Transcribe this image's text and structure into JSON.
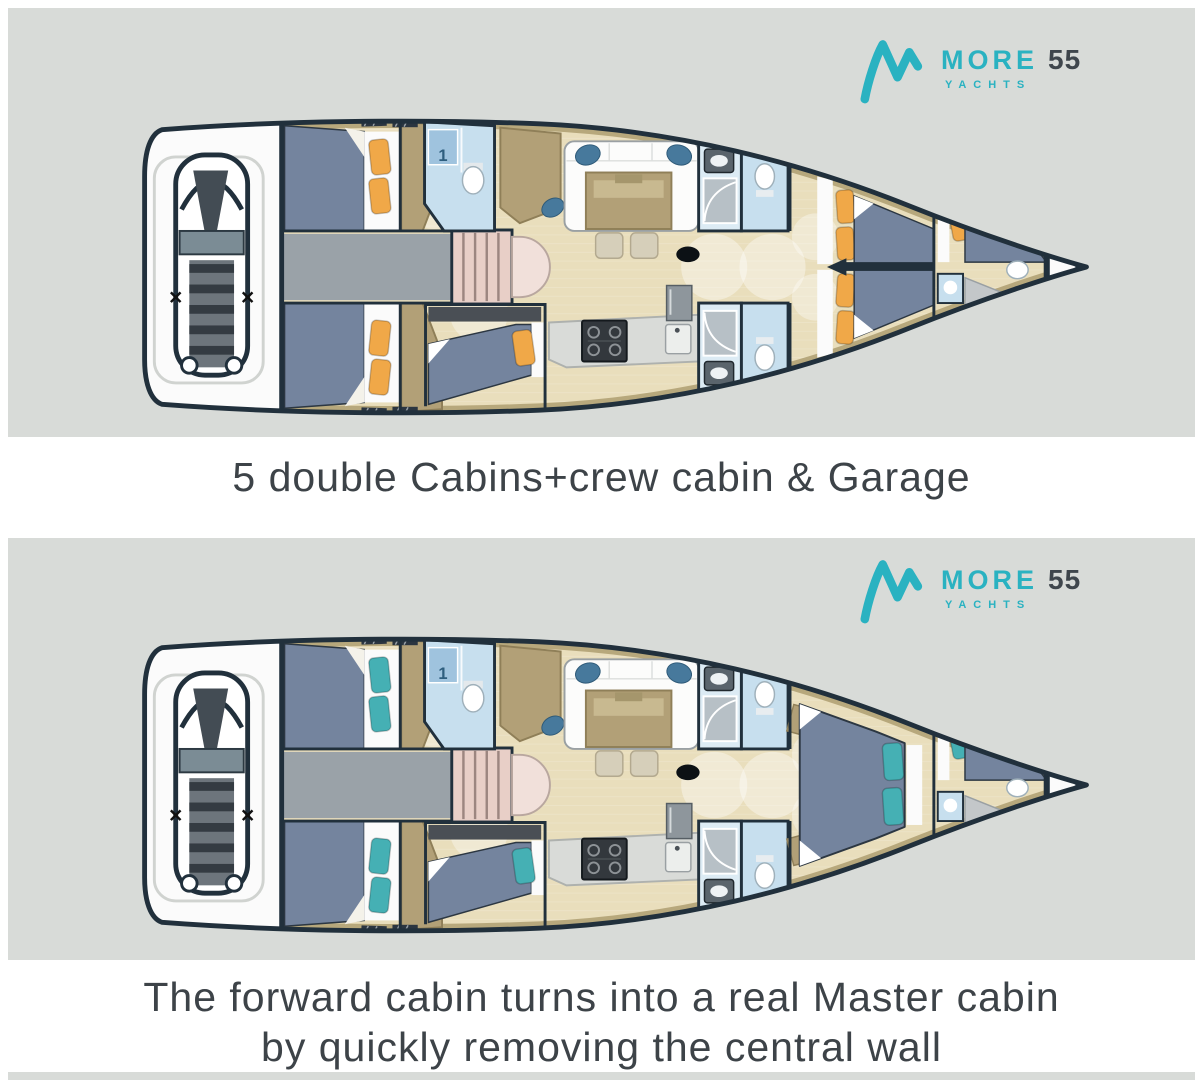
{
  "brand": {
    "name": "MORE",
    "model": "55",
    "subtitle": "YACHTS",
    "teal": "#2ab2c1",
    "dark_text": "#3f464c"
  },
  "panels": [
    {
      "id": "plan-5-cabins",
      "caption_lines": [
        "5 double Cabins+crew cabin & Garage"
      ],
      "pillow_color": "#f0a848",
      "forward_cabin": "two-beds",
      "bathroom_label": "1"
    },
    {
      "id": "plan-master",
      "caption_lines": [
        "The forward cabin turns into a real Master cabin",
        "by quickly removing the central wall"
      ],
      "pillow_color": "#45b0b4",
      "forward_cabin": "master-bed",
      "bathroom_label": "1"
    }
  ],
  "caption_color": "#3d4348",
  "palette": {
    "page_bg": "#ffffff",
    "panel_bg": "#d8dbd8",
    "hull_outline": "#21303c",
    "wood": "#e9debc",
    "liner_tan": "#b4a478",
    "furniture_tan": "#b2a077",
    "furniture_tan_edge": "#8f7f58",
    "bed_blue": "#74849e",
    "bed_edge": "#2c3742",
    "sheet_white": "#fbfbfb",
    "corridor_gray": "#9aa2a8",
    "stairs_pink": "#e8cfc7",
    "stairs_cap": "#f1e0da",
    "bath_blue": "#c7dfee",
    "bath_blue_deep": "#9fc3de",
    "bath_blue_pale": "#dcebf4",
    "shower_gray": "#b7c0c6",
    "appliance_dark": "#33383d",
    "counter_gray": "#d9dbd8",
    "fridge_gray": "#8e969c",
    "chair_blue": "#47799c",
    "hatch_dark": "#2b3540",
    "dinghy_dark": "#434c54",
    "dinghy_seat": "#7b8c95",
    "dinghy_slat": "#6d757c",
    "dinghy_slat_dark": "#343b42",
    "mast_black": "#0c1115"
  }
}
